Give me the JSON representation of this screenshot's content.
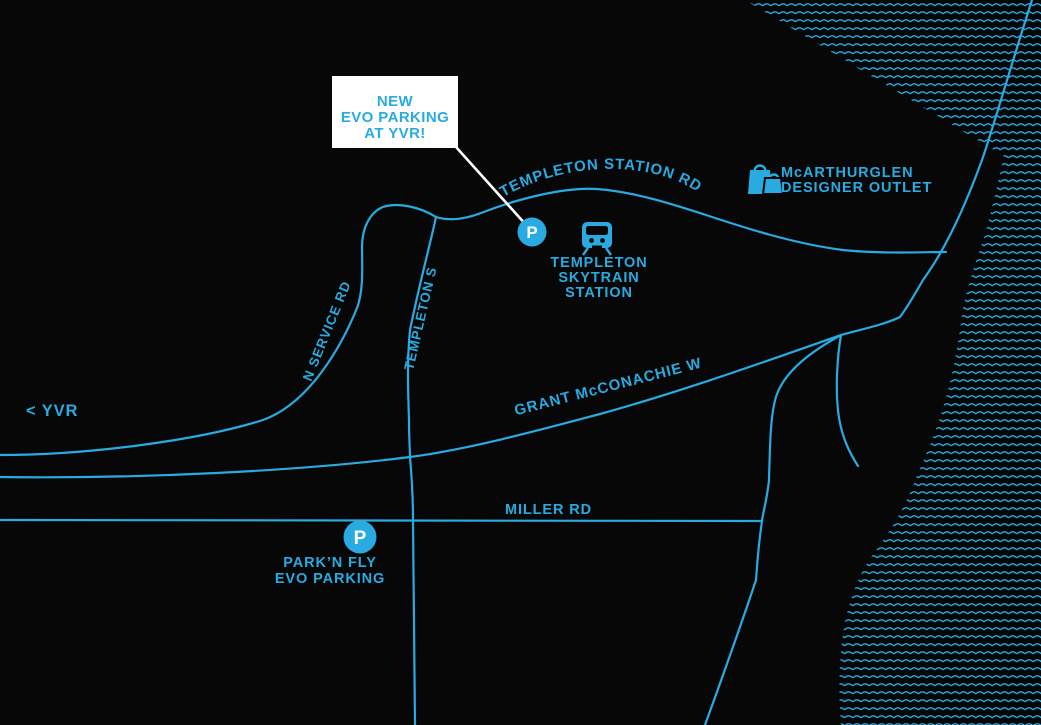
{
  "colors": {
    "background": "#070707",
    "accent": "#29abe2",
    "callout_bg": "#ffffff",
    "marker_letter": "#ffffff"
  },
  "callout": {
    "line1": "NEW",
    "line2": "EVO PARKING",
    "line3": "AT YVR!"
  },
  "roads": {
    "templeton_station_rd": "TEMPLETON STATION RD",
    "templeton_st": "TEMPLETON ST",
    "n_service_rd": "N SERVICE RD",
    "grant_mcconachie_way": "GRANT McCONACHIE WAY",
    "miller_rd": "MILLER RD"
  },
  "places": {
    "mcarthurglen_line1": "McARTHURGLEN",
    "mcarthurglen_line2": "DESIGNER OUTLET",
    "skytrain_line1": "TEMPLETON",
    "skytrain_line2": "SKYTRAIN",
    "skytrain_line3": "STATION",
    "parknfly_line1": "PARK’N FLY",
    "parknfly_line2": "EVO PARKING",
    "yvr_direction": "< YVR"
  },
  "markers": {
    "new_evo_parking": "P",
    "parknfly_parking": "P"
  },
  "icons": {
    "skytrain": "train-icon",
    "outlet": "shopping-bags-icon",
    "new_parking": "parking-marker",
    "parknfly_parking": "parking-marker"
  }
}
